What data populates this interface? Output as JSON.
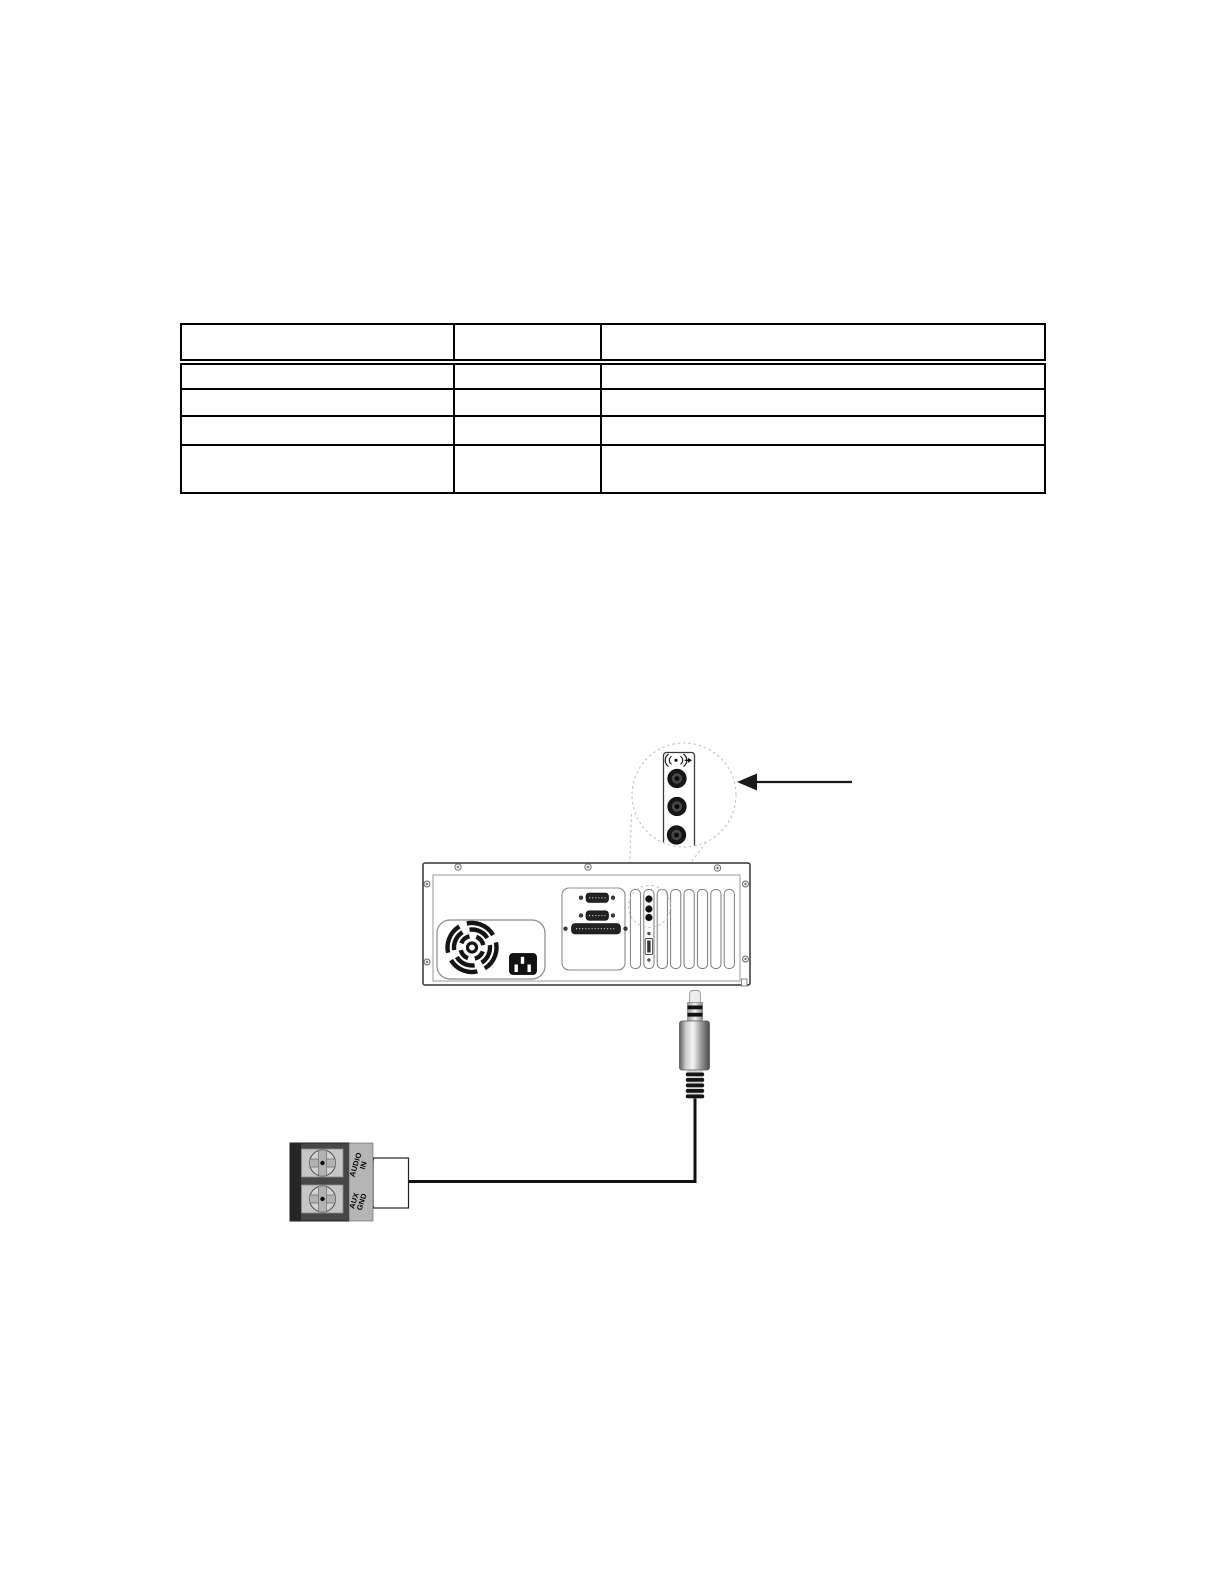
{
  "page": {
    "background": "#ffffff"
  },
  "table": {
    "header": [
      "",
      "",
      ""
    ],
    "rows": [
      [
        "",
        "",
        ""
      ],
      [
        "",
        "",
        ""
      ],
      [
        "",
        "",
        ""
      ],
      [
        "",
        "",
        ""
      ]
    ]
  },
  "diagram": {
    "terminal_labels": {
      "audio_in": [
        "AUDIO",
        "IN"
      ],
      "aux_gnd": [
        "AUX",
        "GND"
      ]
    },
    "colors": {
      "ink": "#1a1a1a",
      "callout_dash": "#c2c2c2",
      "terminal_body": "#474747",
      "terminal_strip": "#b5b5b5"
    }
  }
}
